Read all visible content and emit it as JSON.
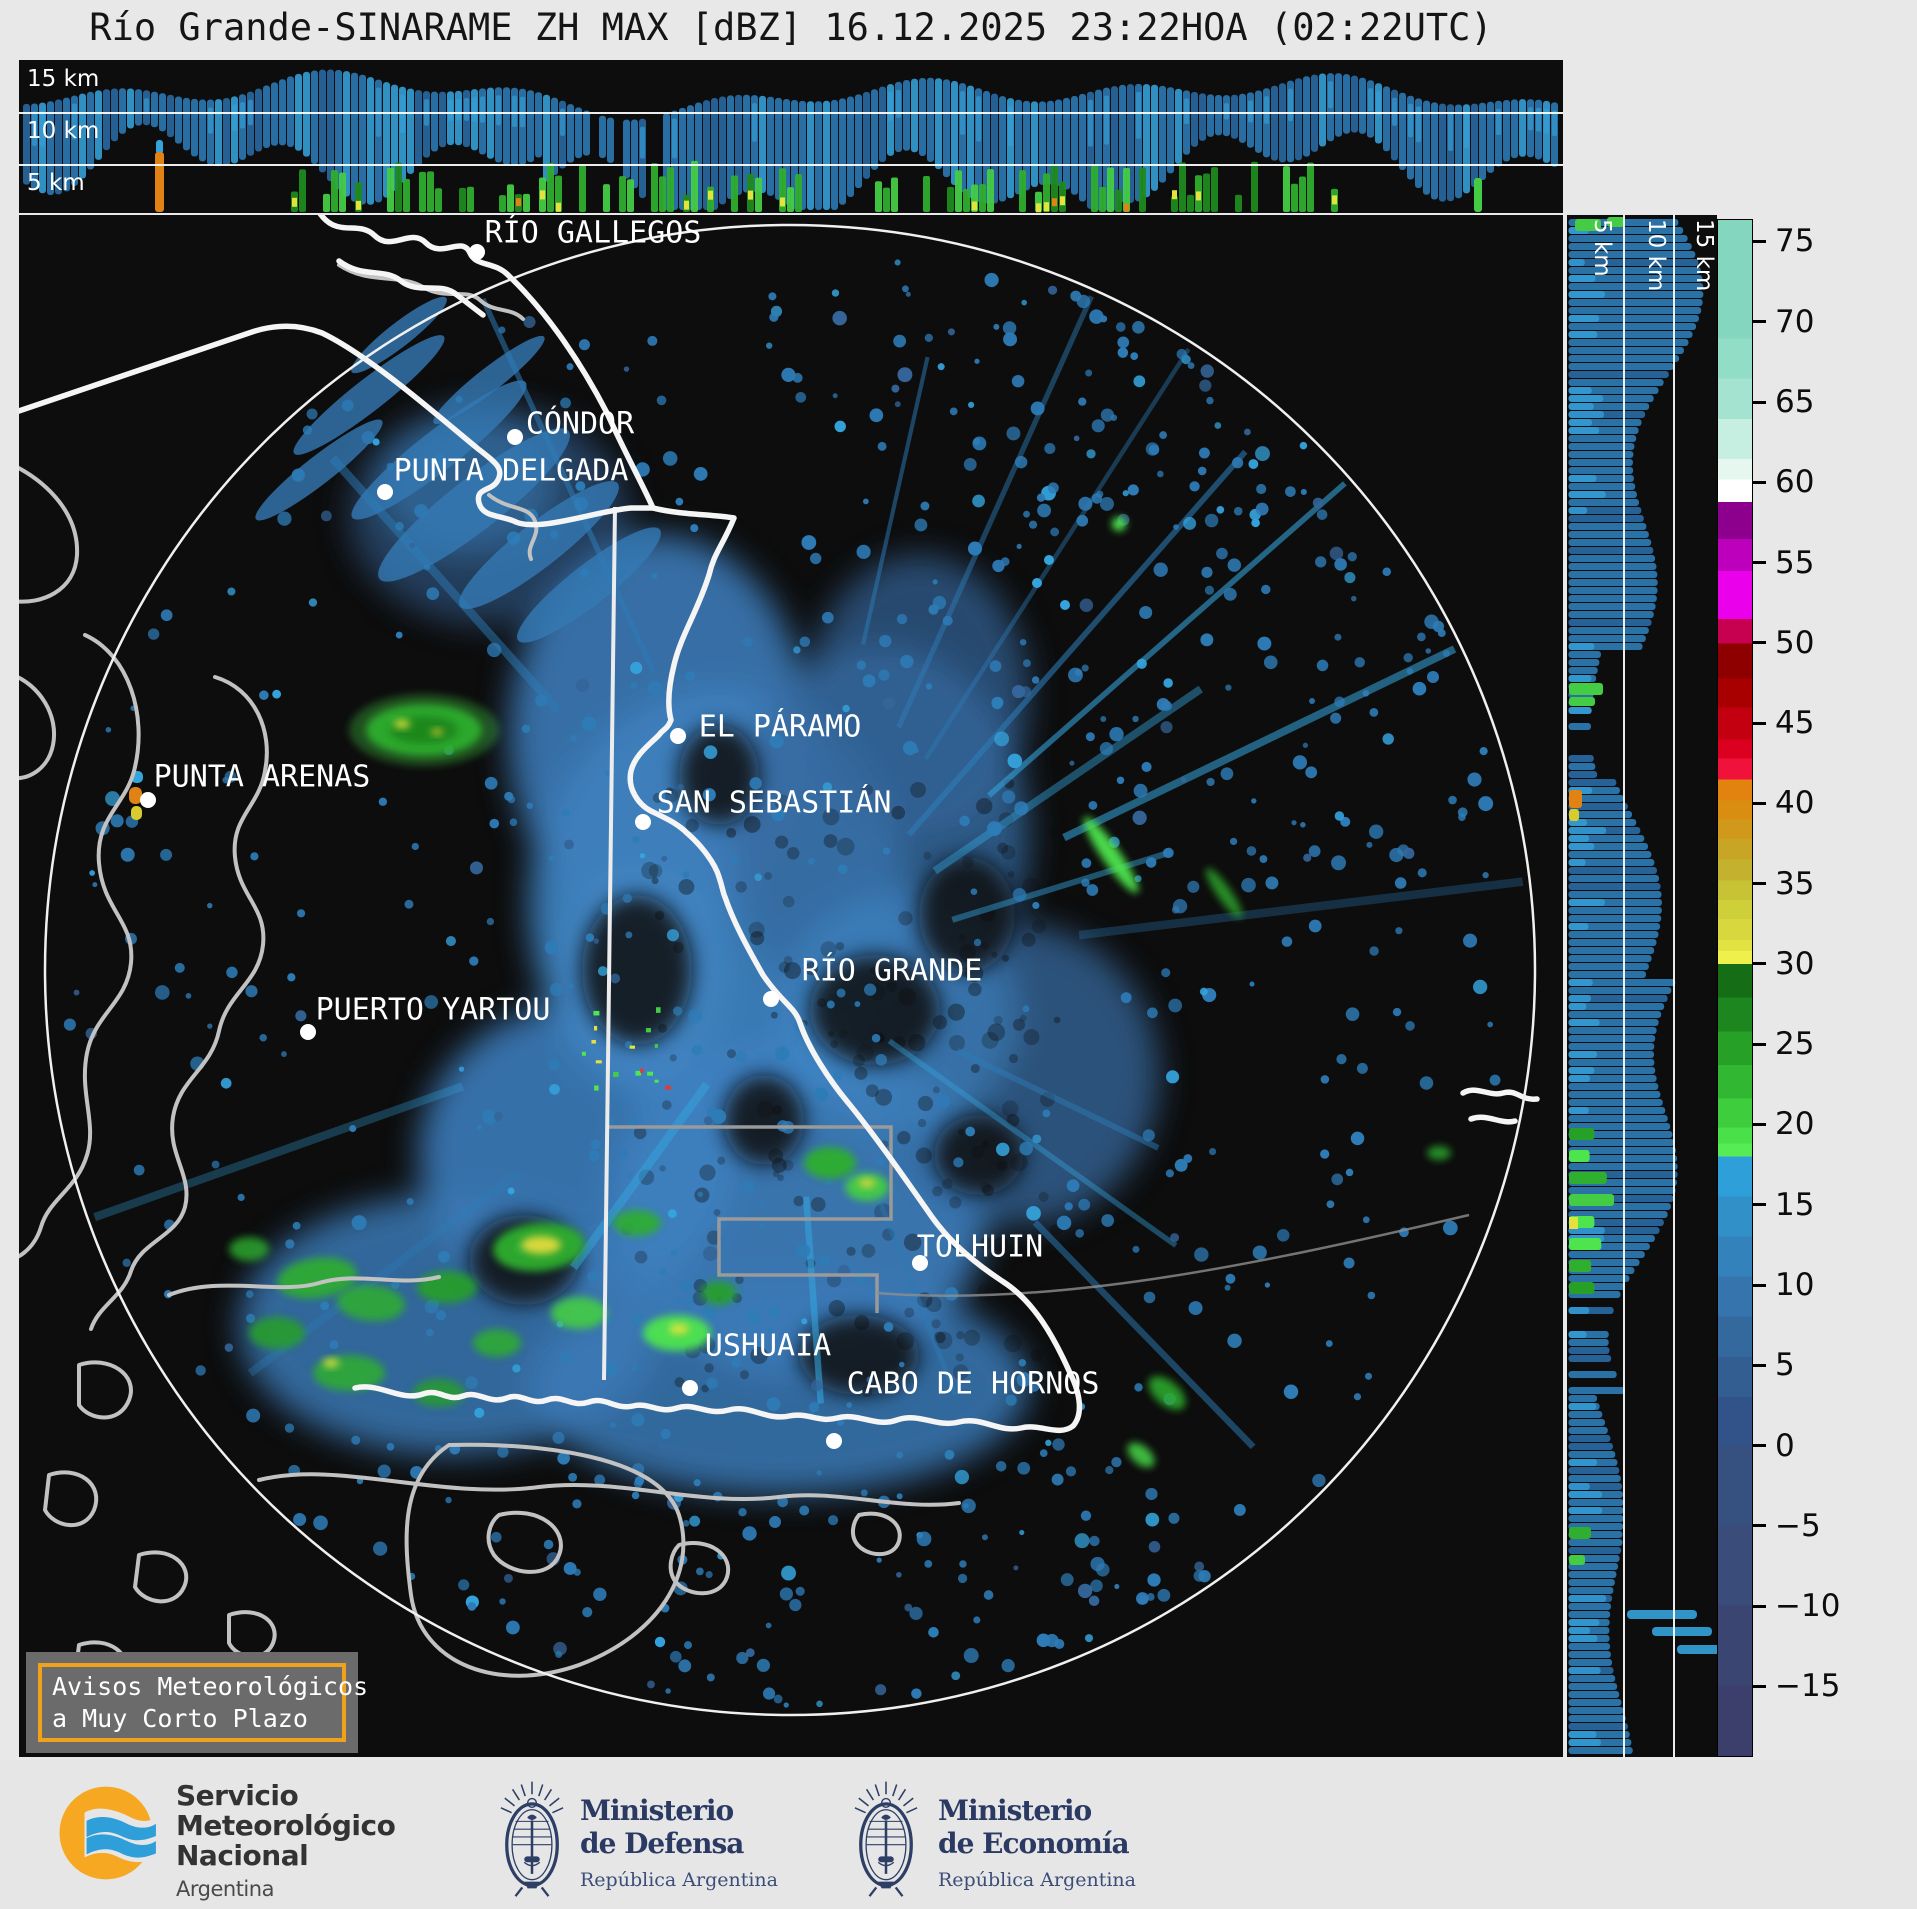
{
  "title": "Río Grande-SINARAME ZH MAX [dBZ] 16.12.2025 23:22HOA (02:22UTC)",
  "product": {
    "radar": "Río Grande-SINARAME",
    "field": "ZH MAX",
    "units": "dBZ",
    "date": "16.12.2025",
    "local_time": "23:22HOA",
    "utc_time": "02:22UTC"
  },
  "top_panel": {
    "altitude_labels": [
      "15 km",
      "10 km",
      "5 km"
    ]
  },
  "right_panel": {
    "altitude_labels": [
      "5 km",
      "10 km",
      "15 km"
    ]
  },
  "colorbar": {
    "unit": "dBZ",
    "tick_values": [
      75,
      70,
      65,
      60,
      55,
      50,
      45,
      40,
      35,
      30,
      25,
      20,
      15,
      10,
      5,
      0,
      -5,
      -10,
      -15
    ],
    "domain_top": 76.4,
    "domain_bottom": -19.4,
    "stops": [
      {
        "until": 69,
        "color": "#84d7be"
      },
      {
        "until": 66.5,
        "color": "#92ddc6"
      },
      {
        "until": 64,
        "color": "#a3e3cf"
      },
      {
        "until": 61.5,
        "color": "#c7efe1"
      },
      {
        "until": 60.2,
        "color": "#e6f7f0"
      },
      {
        "until": 58.8,
        "color": "#ffffff"
      },
      {
        "until": 56.5,
        "color": "#8d008d"
      },
      {
        "until": 54.5,
        "color": "#bc00bc"
      },
      {
        "until": 51.5,
        "color": "#ea00ea"
      },
      {
        "until": 50,
        "color": "#c7004f"
      },
      {
        "until": 47.8,
        "color": "#8e0000"
      },
      {
        "until": 46,
        "color": "#a80000"
      },
      {
        "until": 44,
        "color": "#c30010"
      },
      {
        "until": 42.8,
        "color": "#dc0020"
      },
      {
        "until": 41.5,
        "color": "#f0123a"
      },
      {
        "until": 40.2,
        "color": "#e2830f"
      },
      {
        "until": 39,
        "color": "#da8e11"
      },
      {
        "until": 37.8,
        "color": "#d0991b"
      },
      {
        "until": 36.5,
        "color": "#c8a525"
      },
      {
        "until": 35.2,
        "color": "#c4b22e"
      },
      {
        "until": 34,
        "color": "#c8c335"
      },
      {
        "until": 32.8,
        "color": "#cfcf3a"
      },
      {
        "until": 31.5,
        "color": "#d8d83e"
      },
      {
        "until": 30.8,
        "color": "#e2e243"
      },
      {
        "until": 30,
        "color": "#f0f04c"
      },
      {
        "until": 27.9,
        "color": "#156e15"
      },
      {
        "until": 25.8,
        "color": "#1e861e"
      },
      {
        "until": 23.7,
        "color": "#27a027"
      },
      {
        "until": 21.6,
        "color": "#31b731"
      },
      {
        "until": 19.8,
        "color": "#3dcd3d"
      },
      {
        "until": 18.8,
        "color": "#49e049"
      },
      {
        "until": 18,
        "color": "#55ec55"
      },
      {
        "until": 15.5,
        "color": "#2e9fd8"
      },
      {
        "until": 13,
        "color": "#3290c9"
      },
      {
        "until": 10.5,
        "color": "#3482bb"
      },
      {
        "until": 8,
        "color": "#3574ac"
      },
      {
        "until": 5.5,
        "color": "#34699e"
      },
      {
        "until": 3,
        "color": "#335e92"
      },
      {
        "until": 0,
        "color": "#325389"
      },
      {
        "until": -5,
        "color": "#36517f"
      },
      {
        "until": -10,
        "color": "#3a4c79"
      },
      {
        "until": -15,
        "color": "#3b4572"
      },
      {
        "until": -19.4,
        "color": "#3c3f6b"
      }
    ]
  },
  "map": {
    "radar_site": {
      "x": 771,
      "y": 755
    },
    "range_ring_radius": 745,
    "cities": [
      {
        "name": "RÍO GALLEGOS",
        "label": {
          "x": 574,
          "y": 18
        },
        "dot": {
          "x": 458,
          "y": 37
        }
      },
      {
        "name": "CÓNDOR",
        "label": {
          "x": 561,
          "y": 209
        },
        "dot": {
          "x": 496,
          "y": 222
        }
      },
      {
        "name": "PUNTA DELGADA",
        "label": {
          "x": 492,
          "y": 256
        },
        "dot": {
          "x": 366,
          "y": 277
        }
      },
      {
        "name": "PUNTA ARENAS",
        "label": {
          "x": 243,
          "y": 562
        },
        "dot": {
          "x": 129,
          "y": 585
        }
      },
      {
        "name": "EL PÁRAMO",
        "label": {
          "x": 761,
          "y": 512
        },
        "dot": {
          "x": 659,
          "y": 521
        }
      },
      {
        "name": "SAN SEBASTIÁN",
        "label": {
          "x": 755,
          "y": 588
        },
        "dot": {
          "x": 624,
          "y": 607
        }
      },
      {
        "name": "PUERTO YARTOU",
        "label": {
          "x": 414,
          "y": 795
        },
        "dot": {
          "x": 289,
          "y": 817
        }
      },
      {
        "name": "RÍO GRANDE",
        "label": {
          "x": 873,
          "y": 756
        },
        "dot": {
          "x": 752,
          "y": 784
        }
      },
      {
        "name": "TOLHUIN",
        "label": {
          "x": 961,
          "y": 1032
        },
        "dot": {
          "x": 901,
          "y": 1048
        }
      },
      {
        "name": "USHUAIA",
        "label": {
          "x": 749,
          "y": 1131
        },
        "dot": {
          "x": 671,
          "y": 1173
        }
      },
      {
        "name": "CABO DE HORNOS",
        "label": {
          "x": 954,
          "y": 1169
        },
        "dot": {
          "x": 815,
          "y": 1226
        }
      }
    ]
  },
  "warning_box": {
    "line1": "Avisos Meteorológicos",
    "line2": "a Muy Corto Plazo"
  },
  "footer": {
    "smn": {
      "name_lines": [
        "Servicio",
        "Meteorológico",
        "Nacional"
      ],
      "country": "Argentina"
    },
    "ministries": [
      {
        "line1": "Ministerio",
        "line2": "de Defensa",
        "subtitle": "República Argentina"
      },
      {
        "line1": "Ministerio",
        "line2": "de Economía",
        "subtitle": "República Argentina"
      }
    ]
  },
  "colors": {
    "page_bg": "#e8e8e8",
    "panel_bg": "#0d0d0d",
    "echo_blue": "#2e7cb7",
    "echo_blue_bright": "#49b6e8",
    "echo_blue_dark": "#35659a",
    "echo_blue_soft": "#3b7cba",
    "echo_cyan": "#35a3dc",
    "green": "#2fae2f",
    "green_bright": "#4ee44e",
    "green_dark": "#1e861e",
    "yellow": "#e3e33e",
    "orange": "#e08214",
    "warning_border": "#f0a21c",
    "smn_orange": "#f7a823",
    "smn_blue": "#2e9fd8",
    "ministry_navy": "#2e3f66",
    "coast_white": "#f5f5f5",
    "coast_gray": "#c2c2c2",
    "range_ring": "#f0f0f0"
  }
}
